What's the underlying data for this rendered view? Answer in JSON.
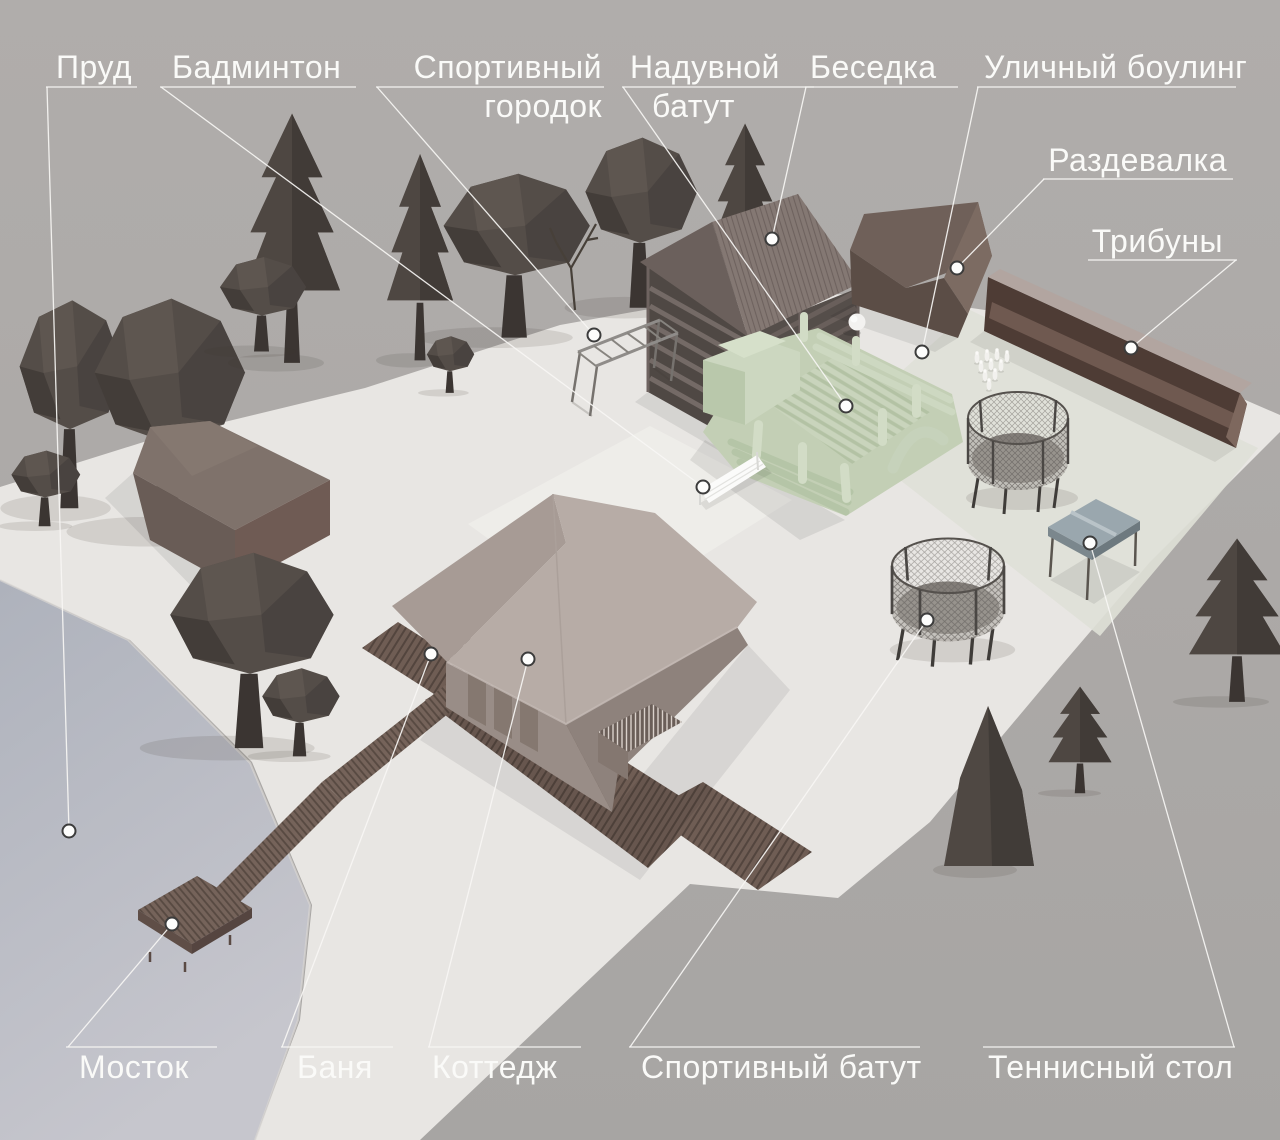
{
  "title": "План базы отдыха",
  "callouts": [
    {
      "id": "prud",
      "label": "Пруд"
    },
    {
      "id": "badminton",
      "label": "Бадминтон"
    },
    {
      "id": "sportivnyy-gorodok",
      "label": "Спортивный городок",
      "line1": "Спортивный",
      "line2": "городок"
    },
    {
      "id": "naduvnoy-batut",
      "label": "Надувной батут",
      "line1": "Надувной",
      "line2": "батут"
    },
    {
      "id": "besedka",
      "label": "Беседка"
    },
    {
      "id": "ulichnyy-bouling",
      "label": "Уличный боулинг"
    },
    {
      "id": "razdevalka",
      "label": "Раздевалка"
    },
    {
      "id": "tribuny",
      "label": "Трибуны"
    },
    {
      "id": "mostok",
      "label": "Мосток"
    },
    {
      "id": "banya",
      "label": "Баня"
    },
    {
      "id": "kottedzh",
      "label": "Коттедж"
    },
    {
      "id": "sportivnyy-batut",
      "label": "Спортивный батут"
    },
    {
      "id": "tennisnyy-stol",
      "label": "Теннисный стол"
    }
  ],
  "colors": {
    "background": "#adaaa8",
    "terrain": "#e8e6e3",
    "pond": "#b6b9c3",
    "label_text": "#fafaf8",
    "leader_line": "#f7f6f4",
    "tree": "#4e4742",
    "wood_dark": "#5b4d46",
    "walkway": "#6f5d54",
    "inflatable_green": "#c6d2ba",
    "tennis_table": "#9aa7ae",
    "bleachers": "#4e3c35",
    "roof_cottage": "#b7aca6"
  }
}
